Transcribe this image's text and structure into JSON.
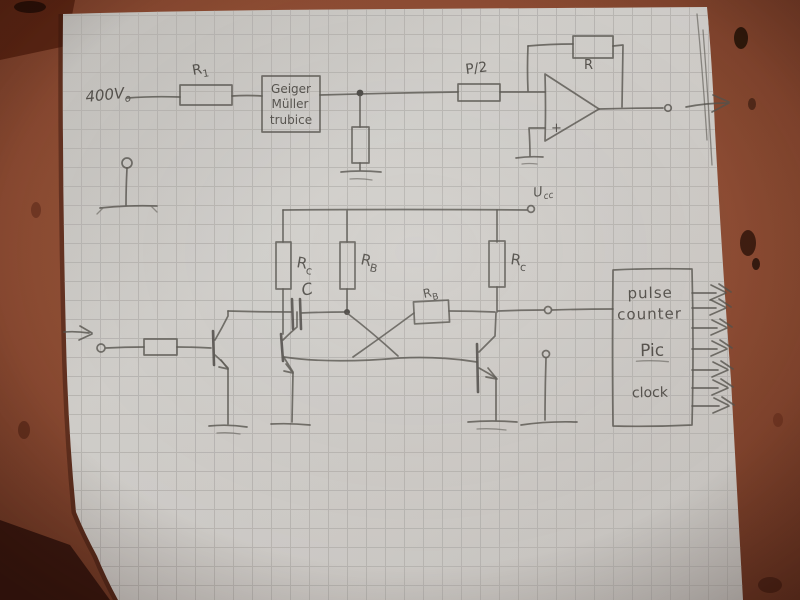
{
  "schematic": {
    "supply_label": {
      "base": "400V",
      "sub": "o"
    },
    "r1_label": {
      "base": "R",
      "sub": "1"
    },
    "tube_box": {
      "line1": "Geiger",
      "line2": "Müller",
      "line3": "trubice"
    },
    "pot_label": "P/2",
    "feedback_resistor_label": "R",
    "opamp_plus_label": "+",
    "ucc_label": {
      "base": "U",
      "sub": "cc"
    },
    "rc_left_label": {
      "base": "R",
      "sub": "c"
    },
    "rb_mid_label": {
      "base": "R",
      "sub": "B"
    },
    "rb_coupling_label": {
      "base": "R",
      "sub": "B"
    },
    "rc_right_label": {
      "base": "R",
      "sub": "c"
    },
    "cap_label": "C",
    "counter_box": {
      "line1": "pulse",
      "line2": "counter",
      "line3": "Pic",
      "line4": "clock"
    }
  },
  "colors": {
    "pencil": "#55524c",
    "paper": "#d0cdc9",
    "grid": "#b5b3af",
    "table": "#8f5038"
  }
}
